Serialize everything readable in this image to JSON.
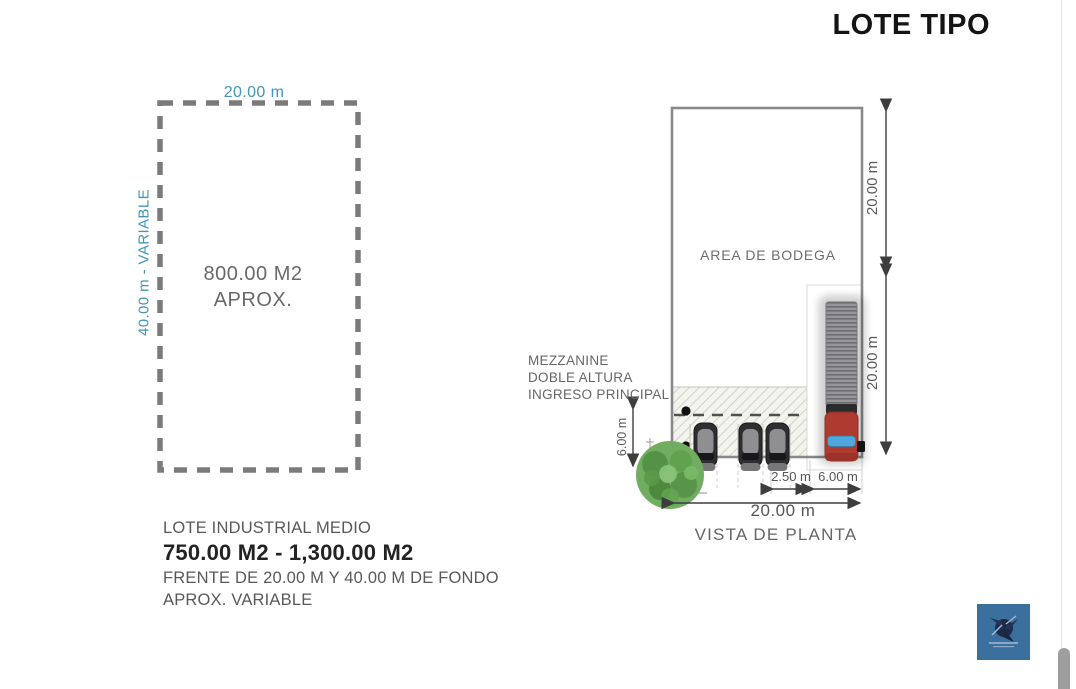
{
  "page": {
    "title": "LOTE TIPO"
  },
  "colors": {
    "accent_blue": "#4295b8",
    "dash_gray": "#7b7b7b",
    "truck_red": "#ae3a30",
    "tree_green": "#6fae5f",
    "logo_blue": "#3b6f9e"
  },
  "lot_sketch": {
    "width_label": "20.00 m",
    "depth_label": "40.00 m - VARIABLE",
    "area_line1": "800.00 M2",
    "area_line2": "APROX.",
    "desc_line1": "LOTE INDUSTRIAL MEDIO",
    "desc_line2": "750.00 M2 - 1,300.00 M2",
    "desc_line3": "FRENTE DE 20.00 M Y 40.00 M DE FONDO",
    "desc_line4": "APROX. VARIABLE"
  },
  "floor_plan": {
    "area_label": "AREA DE BODEGA",
    "annotations": [
      "MEZZANINE",
      "DOBLE ALTURA",
      "INGRESO PRINCIPAL"
    ],
    "dim_right_top": "20.00 m",
    "dim_right_bottom": "20.00 m",
    "dim_entry_depth": "6.00 m",
    "dim_parking": "2.50 m",
    "dim_dock": "6.00 m",
    "dim_front": "20.00 m",
    "caption": "VISTA DE PLANTA"
  }
}
